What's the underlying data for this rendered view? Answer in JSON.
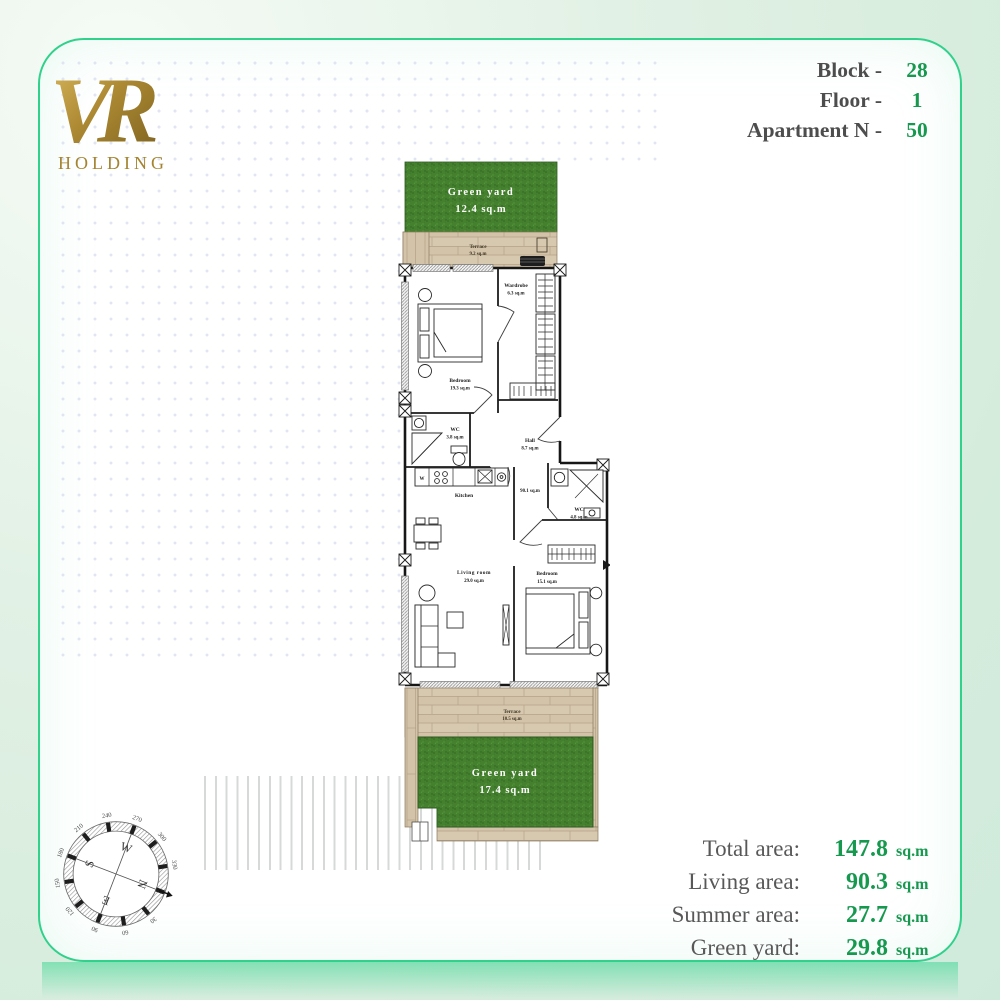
{
  "logo": {
    "monogram": "VR",
    "company": "HOLDING"
  },
  "header": {
    "rows": [
      {
        "label": "Block -",
        "value": "28"
      },
      {
        "label": "Floor -",
        "value": "1"
      },
      {
        "label": "Apartment N -",
        "value": "50"
      }
    ]
  },
  "plan": {
    "green_yard_top": {
      "name": "Green yard",
      "area": "12.4 sq.m"
    },
    "terrace_top": {
      "name": "Terrace",
      "area": "9.2 sq.m"
    },
    "wardrobe": {
      "name": "Wardrobe",
      "area": "6.3 sq.m"
    },
    "bedroom_1": {
      "name": "Bedroom",
      "area": "19.3 sq.m"
    },
    "wc_1": {
      "name": "WC",
      "area": "3.8 sq.m"
    },
    "hall": {
      "name": "Hall",
      "area": "8.7 sq.m"
    },
    "kitchen": {
      "name": "Kitchen"
    },
    "washer": "W",
    "inner_area": "90.1 sq.m",
    "wc_2": {
      "name": "WC",
      "area": "4.8 sq.m"
    },
    "living_room": {
      "name": "Living room",
      "area": "29.0 sq.m"
    },
    "bedroom_2": {
      "name": "Bedroom",
      "area": "15.1 sq.m"
    },
    "terrace_bottom": {
      "name": "Terrace",
      "area": "10.5 sq.m"
    },
    "green_yard_bottom": {
      "name": "Green yard",
      "area": "17.4 sq.m"
    }
  },
  "compass": {
    "letters": {
      "n": "N",
      "e": "E",
      "s": "S",
      "w": "W"
    },
    "numbers": [
      "30",
      "60",
      "90",
      "120",
      "150",
      "180",
      "210",
      "240",
      "270",
      "300",
      "330"
    ]
  },
  "summary": {
    "rows": [
      {
        "label": "Total area:",
        "value": "147.8",
        "unit": "sq.m"
      },
      {
        "label": "Living area:",
        "value": "90.3",
        "unit": "sq.m"
      },
      {
        "label": "Summer area:",
        "value": "27.7",
        "unit": "sq.m"
      },
      {
        "label": "Green yard:",
        "value": "29.8",
        "unit": "sq.m"
      }
    ]
  },
  "colors": {
    "accent_green": "#16994f",
    "border_green": "#2fd18b",
    "gold": "#a5842f"
  }
}
